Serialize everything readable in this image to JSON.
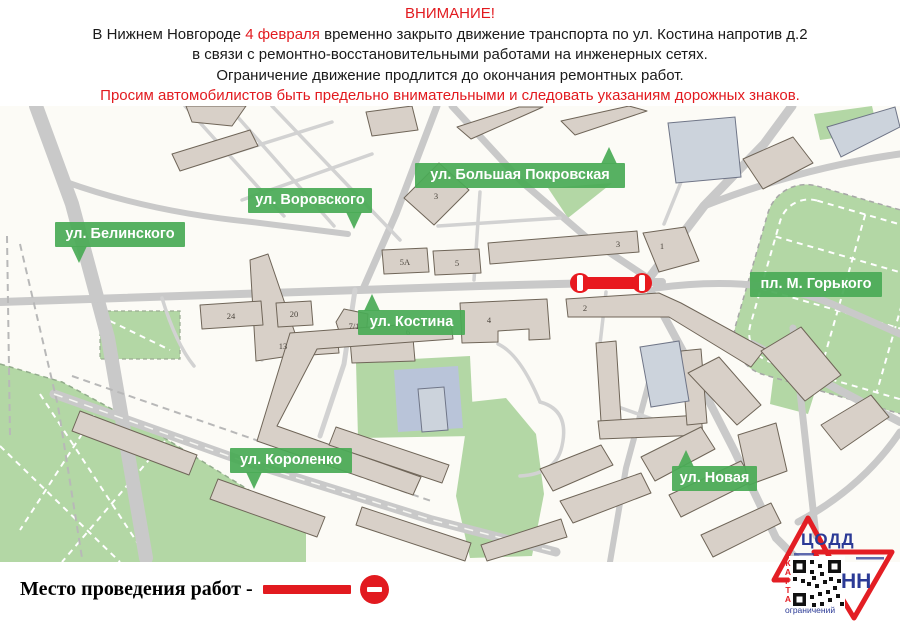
{
  "header": {
    "title": "ВНИМАНИЕ!",
    "line1_prefix": "В Нижнем Новгороде ",
    "line1_date": "4 февраля",
    "line1_suffix": " временно закрыто движение транспорта по ул. Костина напротив д.2",
    "line2": "в связи с ремонтно-восстановительными работами на инженерных сетях.",
    "line3": "Ограничение движение продлится до окончания ремонтных работ.",
    "line4": "Просим автомобилистов быть предельно внимательными и следовать указаниям дорожных знаков.",
    "accent_color": "#e21a1f"
  },
  "map": {
    "badge_color": "#4aab56",
    "closure_color": "#e8191f",
    "street_labels": [
      {
        "id": "belinskogo",
        "label": "ул. Белинского",
        "x": 55,
        "y": 116,
        "w": 130,
        "pointer": "bottom-left"
      },
      {
        "id": "vorovskogo",
        "label": "ул. Воровского",
        "x": 248,
        "y": 82,
        "w": 124,
        "pointer": "bottom-right"
      },
      {
        "id": "bolshaya-pokrovskaya",
        "label": "ул. Большая Покровская",
        "x": 415,
        "y": 57,
        "w": 210,
        "pointer": "top-right"
      },
      {
        "id": "gorkogo",
        "label": "пл. М. Горького",
        "x": 750,
        "y": 166,
        "w": 132,
        "pointer": "none"
      },
      {
        "id": "kostina",
        "label": "ул. Костина",
        "x": 358,
        "y": 204,
        "w": 107,
        "pointer": "top-left"
      },
      {
        "id": "korolenko",
        "label": "ул. Короленко",
        "x": 230,
        "y": 342,
        "w": 122,
        "pointer": "bottom-left"
      },
      {
        "id": "novaya",
        "label": "ул. Новая",
        "x": 672,
        "y": 360,
        "w": 85,
        "pointer": "top-left"
      }
    ],
    "building_numbers": [
      {
        "t": "13",
        "x": 283,
        "y": 240
      },
      {
        "t": "24",
        "x": 231,
        "y": 210
      },
      {
        "t": "20",
        "x": 294,
        "y": 208
      },
      {
        "t": "7/1",
        "x": 354,
        "y": 220
      },
      {
        "t": "5А",
        "x": 405,
        "y": 156
      },
      {
        "t": "5",
        "x": 457,
        "y": 157
      },
      {
        "t": "3",
        "x": 436,
        "y": 90
      },
      {
        "t": "3",
        "x": 618,
        "y": 138
      },
      {
        "t": "1",
        "x": 662,
        "y": 140
      },
      {
        "t": "4",
        "x": 489,
        "y": 214
      },
      {
        "t": "2",
        "x": 585,
        "y": 202
      },
      {
        "t": "6",
        "x": 408,
        "y": 226
      }
    ]
  },
  "legend": {
    "text": "Место проведения работ -"
  },
  "logo": {
    "org": "ЦОДД",
    "city": "НН",
    "qr_side_label": "КАРТА",
    "qr_caption": "ограничений",
    "red": "#e31e24",
    "blue": "#2b3a96"
  }
}
